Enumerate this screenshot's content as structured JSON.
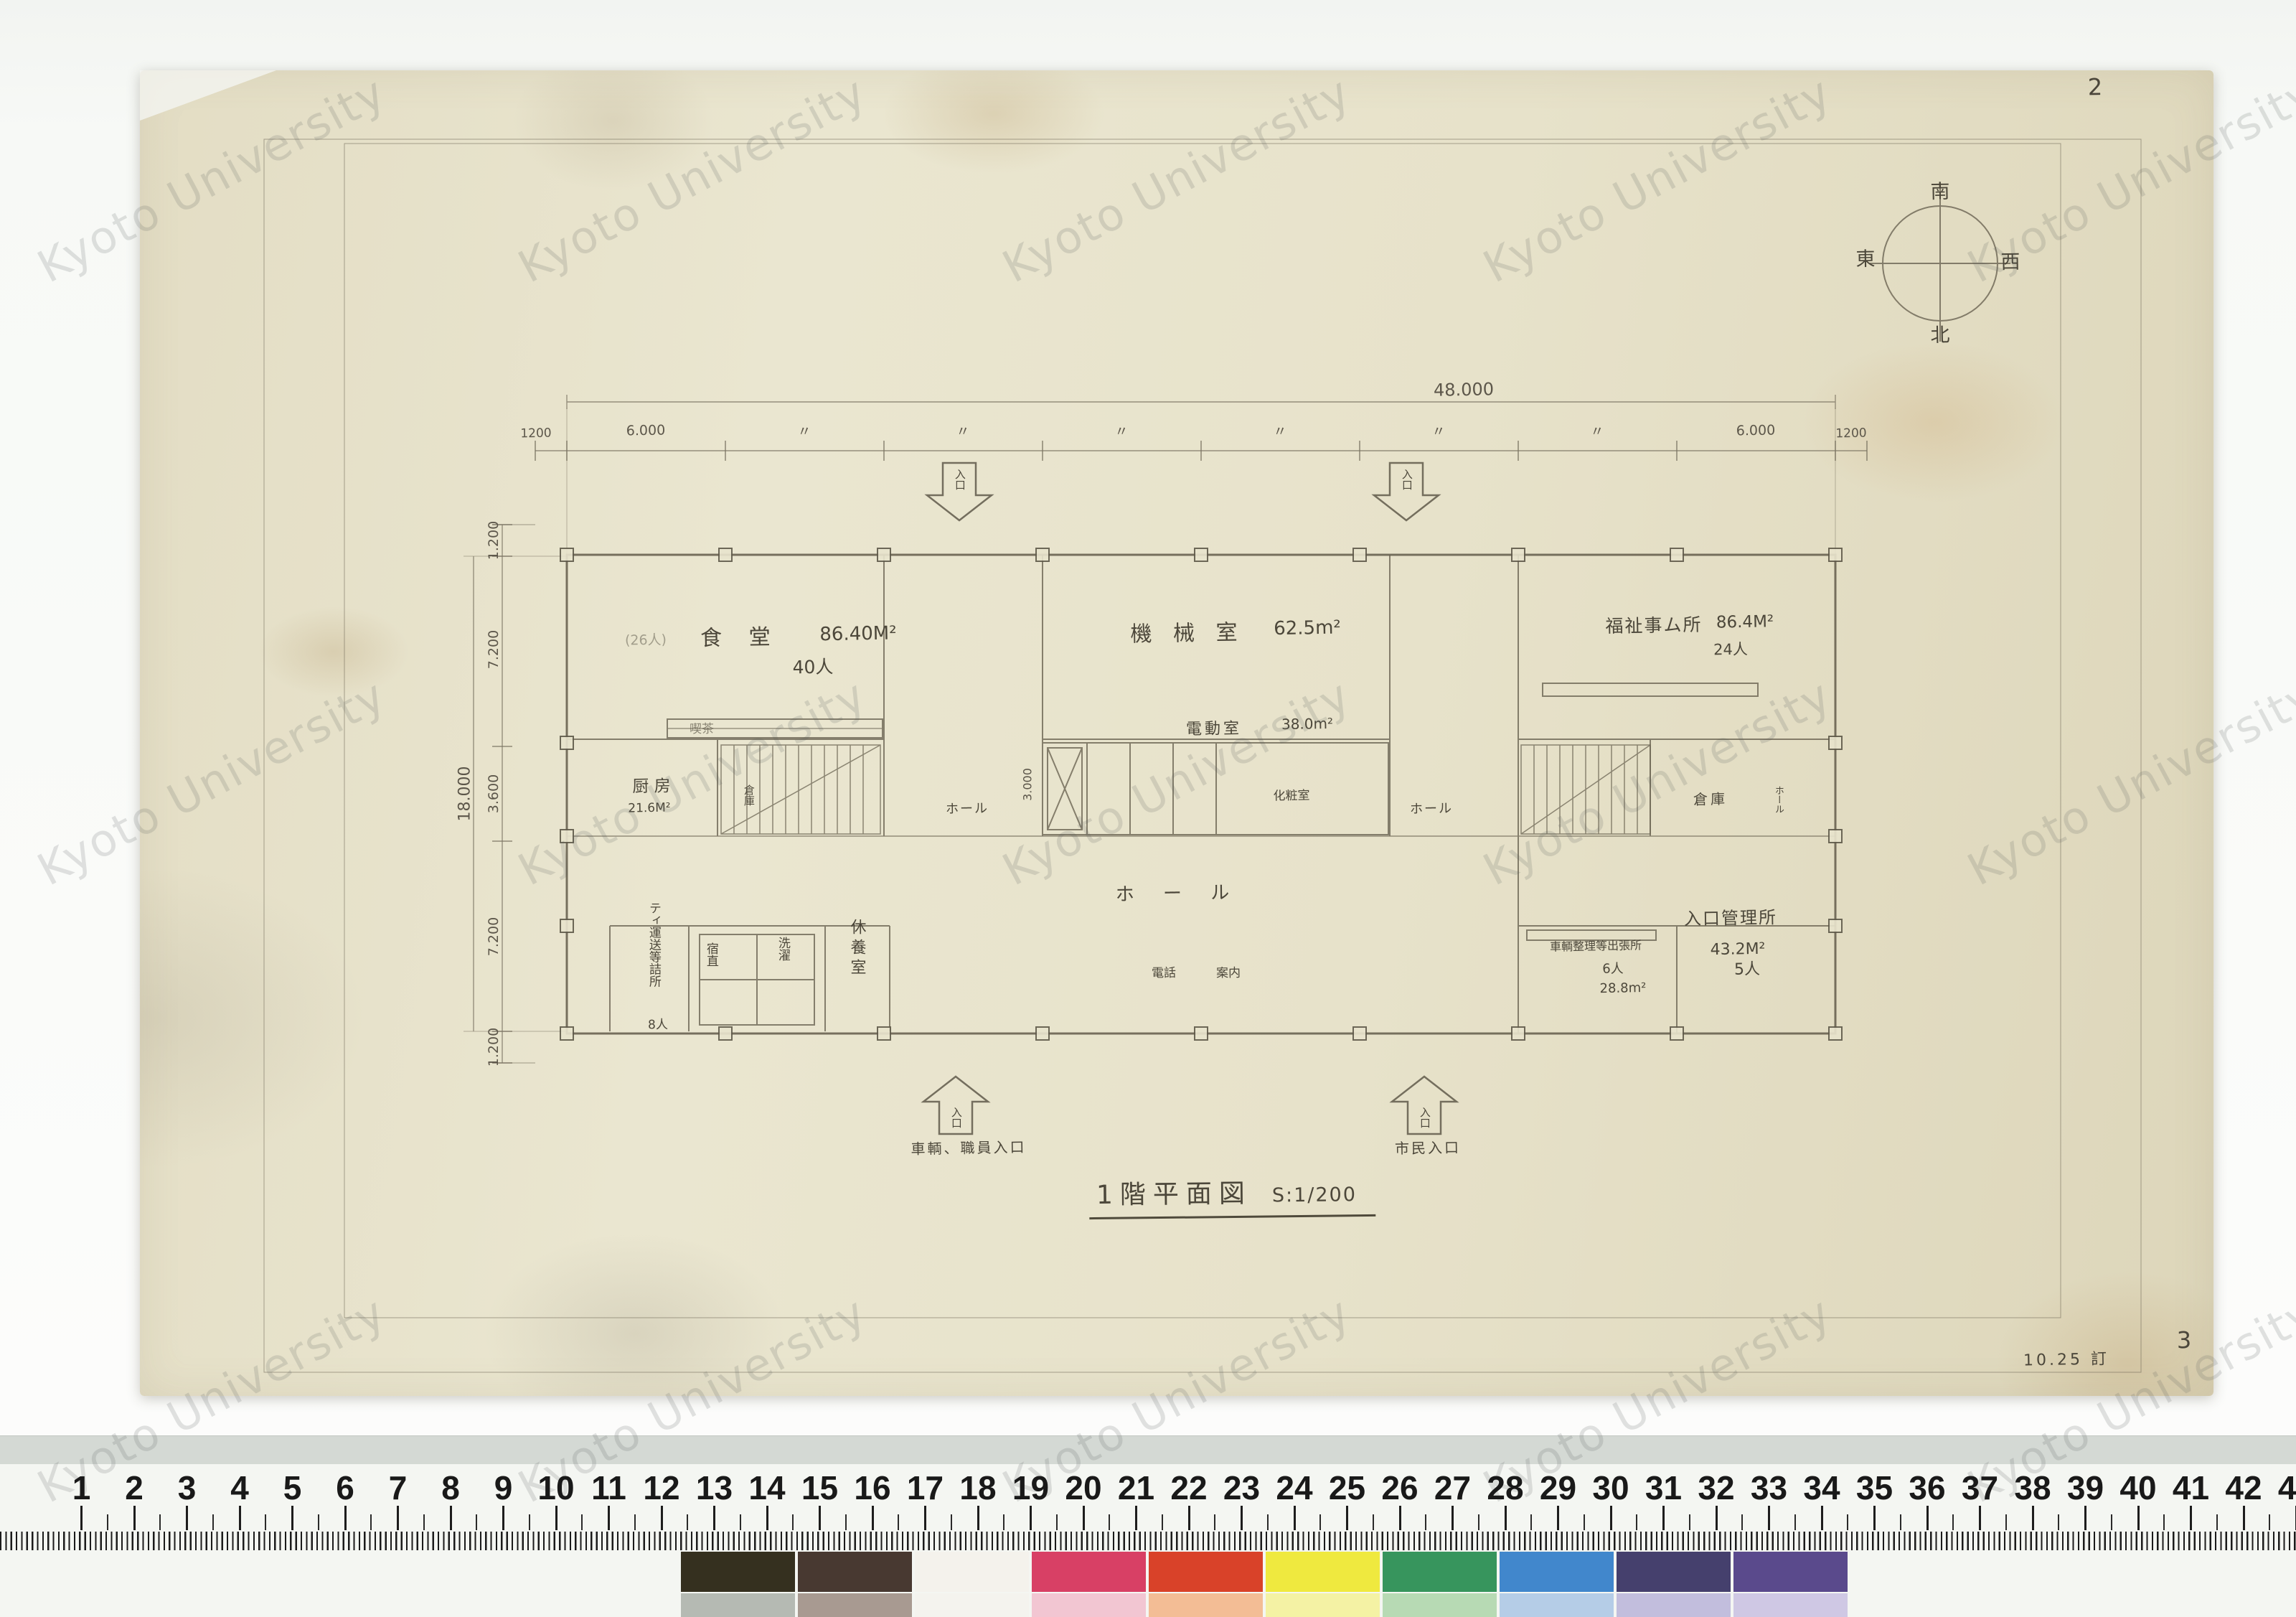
{
  "watermark": {
    "text": "Kyoto University"
  },
  "page": {
    "sheet_number_top": "2",
    "sheet_number_bottom": "3",
    "revision_note": "10.25 訂"
  },
  "title": {
    "name": "1階平面図",
    "scale": "S:1/200"
  },
  "compass": {
    "top": "南",
    "bottom": "北",
    "left": "東",
    "right": "西"
  },
  "dimensions": {
    "overall_width": "48.000",
    "top_labels": [
      "1200",
      "6.000",
      "〃",
      "〃",
      "〃",
      "〃",
      "〃",
      "〃",
      "6.000",
      "1200"
    ],
    "overall_height": "18.000",
    "left_labels": [
      "1.200",
      "7.200",
      "3.600",
      "7.200",
      "1.200"
    ],
    "hall_depth": "3.000"
  },
  "entrances": {
    "arrow_text": "入口",
    "north_left_caption": "車輌、職員入口",
    "north_right_caption": "市民入口"
  },
  "rooms": {
    "dining": {
      "name": "食 堂",
      "area": "86.40M²",
      "capacity": "40人",
      "note": "(26人)"
    },
    "cafe": {
      "name": "喫茶"
    },
    "kitchen": {
      "name": "厨 房",
      "area": "21.6M²"
    },
    "storage_left": {
      "name": "倉庫"
    },
    "machine": {
      "name": "機 械 室",
      "area": "62.5m²"
    },
    "electric": {
      "name": "電動室",
      "area": "38.0m²"
    },
    "powder": {
      "name": "化粧室"
    },
    "hall_left": {
      "name": "ホール"
    },
    "hall_right": {
      "name": "ホール"
    },
    "hall_main": {
      "name": "ホ ー ル"
    },
    "phone": {
      "name": "電話"
    },
    "info": {
      "name": "案内"
    },
    "rest": {
      "name": "休養室"
    },
    "crew": {
      "name": "ティ運送等詰所",
      "capacity": "8人"
    },
    "night_duty": {
      "name": "宿直"
    },
    "laundry": {
      "name": "洗濯"
    },
    "welfare": {
      "name": "福祉事ム所",
      "area": "86.4M²",
      "capacity": "24人"
    },
    "storage_right": {
      "name": "倉庫"
    },
    "hall_small_right": {
      "name": "ホール"
    },
    "dispatch": {
      "name": "車輌整理等出張所",
      "capacity": "6人",
      "area": "28.8m²"
    },
    "entrance_admin": {
      "name": "入口管理所",
      "area": "43.2M²",
      "capacity": "5人"
    }
  },
  "ruler": {
    "numbers": [
      1,
      2,
      3,
      4,
      5,
      6,
      7,
      8,
      9,
      10,
      11,
      12,
      13,
      14,
      15,
      16,
      17,
      18,
      19,
      20,
      21,
      22,
      23,
      24,
      25,
      26,
      27,
      28,
      29,
      30,
      31,
      32,
      33,
      34,
      35,
      36,
      37,
      38,
      39,
      40,
      41,
      42,
      43
    ]
  },
  "color_patches": {
    "top_row": [
      "#35301f",
      "#483931",
      "#f4f2ec",
      "#d84065",
      "#d94229",
      "#efe93f",
      "#37955d",
      "#4187cc",
      "#45406d",
      "#5a4a8c"
    ],
    "bottom_row": [
      "#b5bab3",
      "#a89a91",
      "#f4f3ee",
      "#f2c6d2",
      "#f3bd95",
      "#f4f2a4",
      "#b7dab4",
      "#b5cde7",
      "#c2bedd",
      "#cfc8e4"
    ]
  }
}
